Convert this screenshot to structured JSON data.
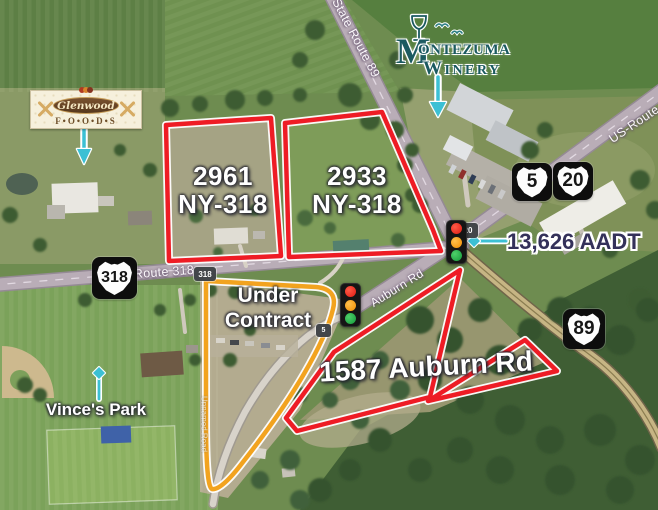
{
  "annotations": {
    "traffic_count": "13,626 AADT",
    "park_label": "Vince's Park"
  },
  "parcels": {
    "p2961": {
      "line1": "2961",
      "line2": "NY-318"
    },
    "p2933": {
      "line1": "2933",
      "line2": "NY-318"
    },
    "under_contract": {
      "line1": "Under",
      "line2": "Contract"
    },
    "p1587": {
      "label": "1587 Auburn Rd"
    }
  },
  "roads": {
    "state_route_89": "State Route 89",
    "us_route": "US-Route",
    "route_318": "Route 318",
    "auburn_rd": "Auburn Rd",
    "local_road": "Unnamed Road"
  },
  "shields": {
    "big_318": "318",
    "small_318": "318",
    "big_5": "5",
    "big_20": "20",
    "big_89": "89",
    "small_5": "5",
    "small_20": "20"
  },
  "logos": {
    "montezuma": {
      "monogram": "M",
      "rest_line1": "ONTEZUMA",
      "line2": "WINERY"
    },
    "glenwood": {
      "name": "Glenwood",
      "sub": "F•O•O•D•S"
    }
  },
  "colors": {
    "parcel_red": "#ee1c25",
    "parcel_orange": "#f2a31f",
    "leader_teal": "#3cc0d4",
    "aadt_text": "#34315a"
  }
}
